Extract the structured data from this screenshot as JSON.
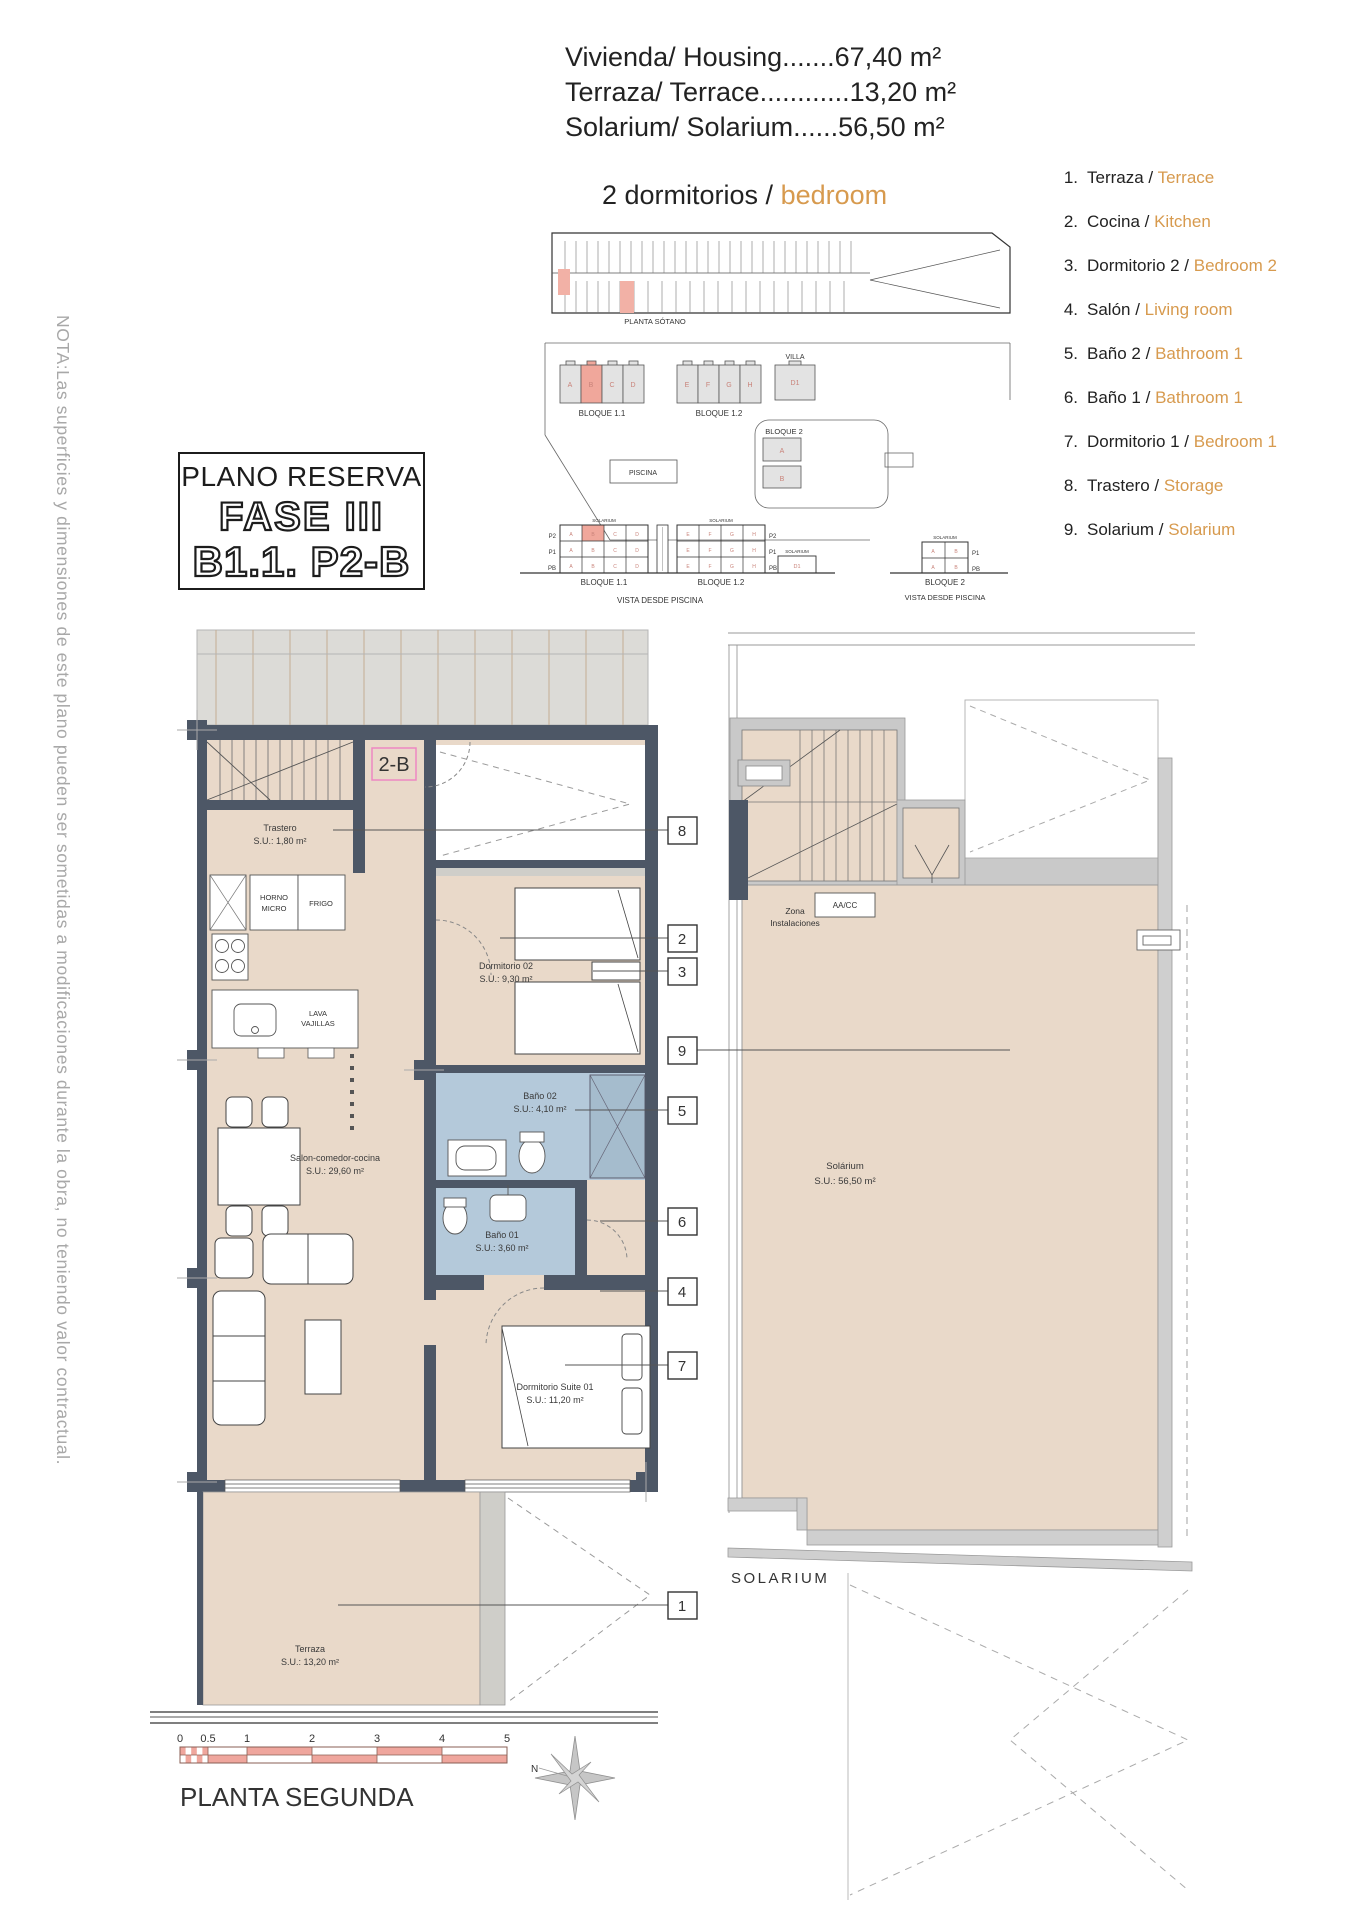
{
  "header": {
    "line1": "Vivienda/ Housing.......67,40 m²",
    "line2": "Terraza/ Terrace............13,20 m²",
    "line3": "Solarium/ Solarium......56,50 m²",
    "subtitle_prefix": "2 dormitorios / ",
    "subtitle_accent": "bedroom"
  },
  "reserva": {
    "title": "PLANO RESERVA",
    "fase": "FASE III",
    "unit": "B1.1. P2-B"
  },
  "legend": {
    "items": [
      {
        "n": "1.",
        "es": "Terraza / ",
        "en": "Terrace"
      },
      {
        "n": "2.",
        "es": "Cocina / ",
        "en": "Kitchen"
      },
      {
        "n": "3.",
        "es": "Dormitorio 2 / ",
        "en": "Bedroom 2"
      },
      {
        "n": "4.",
        "es": "Salón / ",
        "en": "Living room"
      },
      {
        "n": "5.",
        "es": "Baño 2 / ",
        "en": "Bathroom 1"
      },
      {
        "n": "6.",
        "es": "Baño 1 / ",
        "en": "Bathroom 1"
      },
      {
        "n": "7.",
        "es": "Dormitorio 1 / ",
        "en": "Bedroom 1"
      },
      {
        "n": "8.",
        "es": "Trastero / ",
        "en": "Storage"
      },
      {
        "n": "9.",
        "es": "Solarium / ",
        "en": "Solarium"
      }
    ]
  },
  "note": "NOTA:Las superficies y dimensiones de este plano pueden ser sometidas a modificaciones durante la obra, no teniendo valor contractual.",
  "site": {
    "planta_sotano": "PLANTA SÓTANO",
    "bloque11": "BLOQUE 1.1",
    "bloque12": "BLOQUE 1.2",
    "bloque2": "BLOQUE 2",
    "villa": "VILLA",
    "piscina": "PISCINA",
    "vista": "VISTA DESDE PISCINA",
    "solarium_small": "SOLARIUM",
    "d1": "D1",
    "b11_units": [
      "A",
      "B",
      "C",
      "D"
    ],
    "b12_units": [
      "E",
      "F",
      "G",
      "H"
    ],
    "b2_units": [
      "A",
      "B"
    ],
    "floors": [
      "P2",
      "P1",
      "PB"
    ],
    "b2_floors": [
      "P1",
      "PB"
    ]
  },
  "plan": {
    "unit_label": "2-B",
    "trastero_name": "Trastero",
    "trastero_area": "S.U.: 1,80 m²",
    "dorm02_name": "Dormitorio 02",
    "dorm02_area": "S.U.: 9,30 m²",
    "bano02_name": "Baño 02",
    "bano02_area": "S.U.: 4,10 m²",
    "bano01_name": "Baño 01",
    "bano01_area": "S.U.: 3,60 m²",
    "salon_name": "Salon-comedor-cocina",
    "salon_area": "S.U.: 29,60 m²",
    "suite_name": "Dormitorio Suite 01",
    "suite_area": "S.U.: 11,20 m²",
    "terraza_name": "Terraza",
    "terraza_area": "S.U.: 13,20 m²",
    "horno1": "HORNO",
    "horno2": "MICRO",
    "frigo": "FRIGO",
    "lava1": "LAVA",
    "lava2": "VAJILLAS",
    "callouts": {
      "c1": "1",
      "c2": "2",
      "c3": "3",
      "c4": "4",
      "c5": "5",
      "c6": "6",
      "c7": "7",
      "c8": "8",
      "c9": "9"
    }
  },
  "solarium": {
    "name": "Solárium",
    "area": "S.U.: 56,50 m²",
    "zona1": "Zona",
    "zona2": "Instalaciones",
    "aacc": "AA/CC",
    "num19": "19",
    "caption": "SOLARIUM"
  },
  "footer": {
    "ticks": [
      "0",
      "0.5",
      "1",
      "2",
      "3",
      "4",
      "5"
    ],
    "plan_name": "PLANTA SEGUNDA",
    "north": "N"
  },
  "colors": {
    "accent_orange": "#D79A4E",
    "highlight_pink": "#F0A79B",
    "unit_pink": "#EE87C2",
    "bath_blue": "#B4C9DA",
    "room_tan": "#E9D9C9",
    "wall_dark": "#4D5766",
    "concrete_gray": "#C9C9C9",
    "red_letter": "#C9837A"
  }
}
